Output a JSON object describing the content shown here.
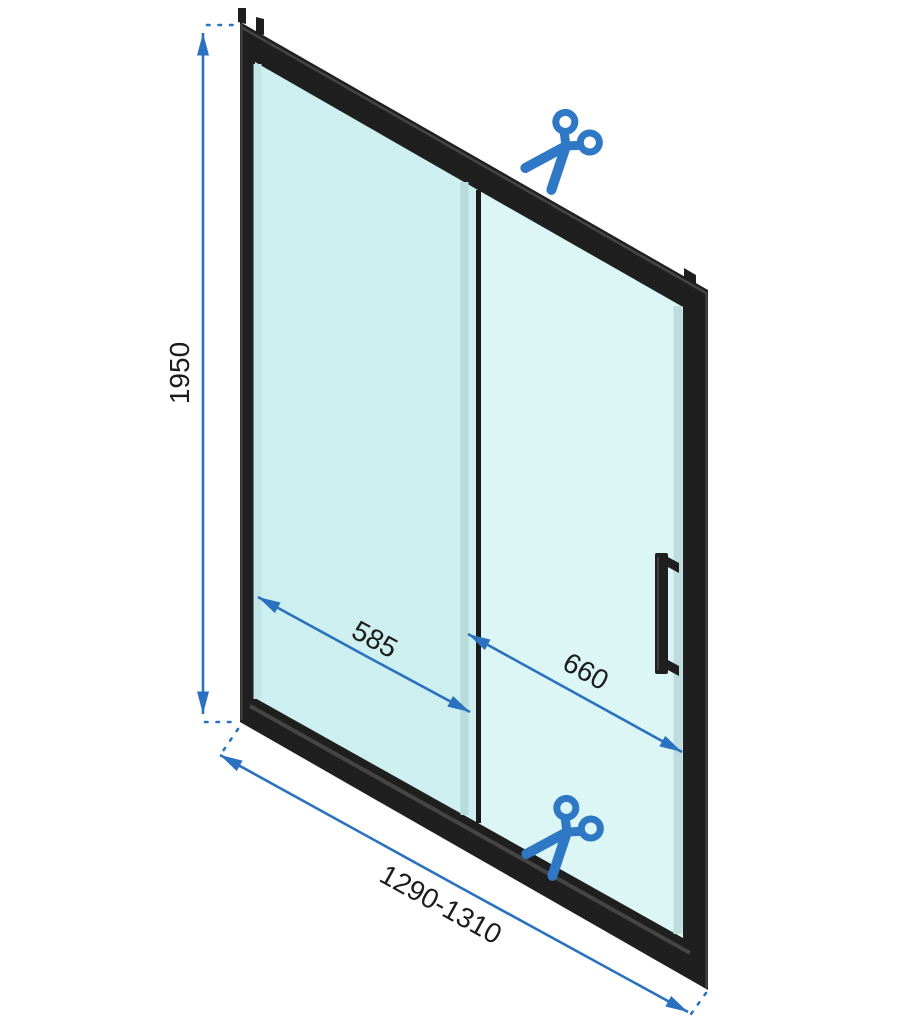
{
  "diagram": {
    "dimensions": {
      "height": "1950",
      "fixed_panel_width": "585",
      "sliding_panel_width": "660",
      "total_width_range": "1290-1310"
    },
    "icons": {
      "top": "scissors-icon",
      "bottom": "scissors-icon"
    },
    "colors": {
      "dimension_line": "#2a72c0",
      "scissors": "#2e78c6",
      "frame": "#1f1f1f",
      "frame_bevel": "#454545",
      "glass_fixed": "#cdeff0",
      "glass_sliding": "#dbf6f4",
      "glass_edge": "#b7dadb",
      "label_text": "#1c1c1c",
      "background": "#ffffff"
    }
  }
}
